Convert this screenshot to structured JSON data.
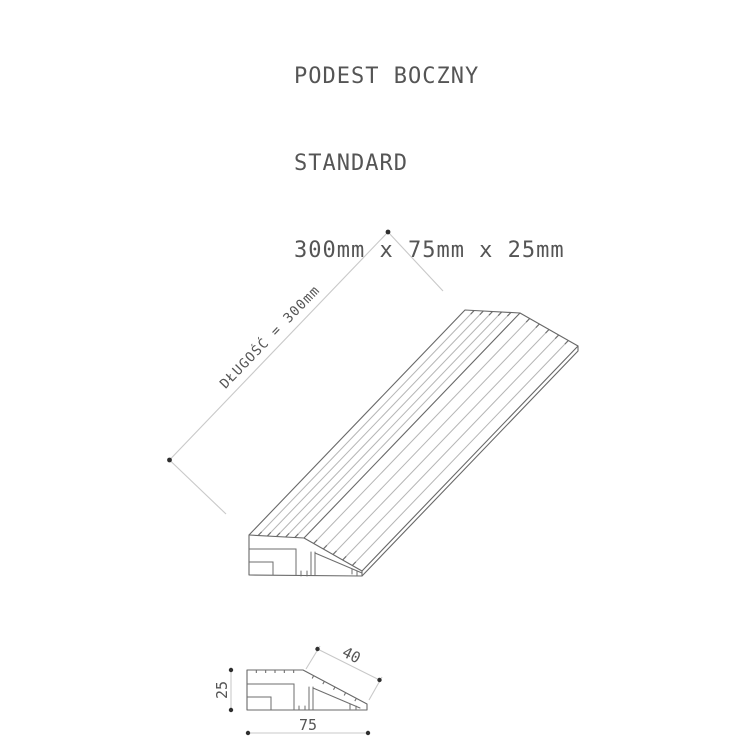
{
  "title": {
    "line1": "PODEST BOCZNY",
    "line2": "STANDARD",
    "line3": "300mm x 75mm x 25mm"
  },
  "iso_view": {
    "length_label": "DŁUGOŚĆ = 300mm",
    "ribs_top": 5,
    "ribs_ramp": 5
  },
  "section_view": {
    "height_label": "25",
    "width_label": "75",
    "slope_label": "40"
  },
  "colors": {
    "outline": "#686868",
    "rib": "#b5b5b5",
    "rib_end": "#707070",
    "dimension_line": "#c9c9c9",
    "dimension_dot": "#2f2f2f",
    "text": "#555555"
  }
}
